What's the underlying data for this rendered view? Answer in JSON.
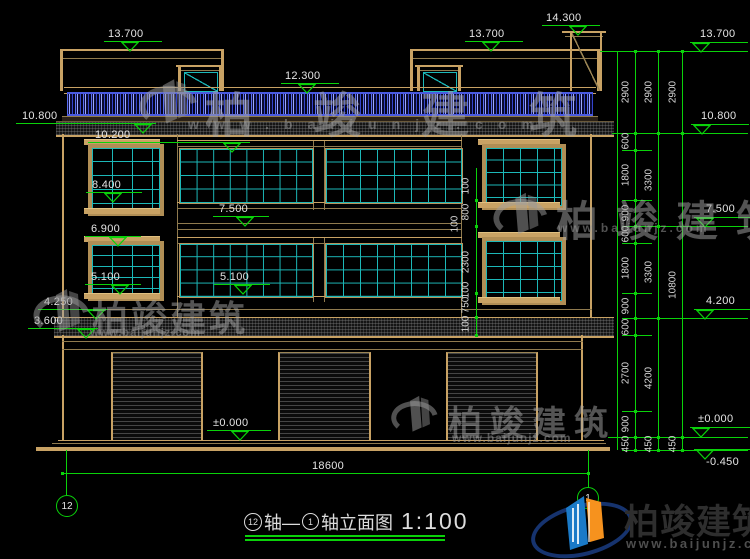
{
  "drawing": {
    "title": {
      "axis_start": "12",
      "axis_mid": "轴—",
      "axis_end": "1",
      "name": "轴立面图",
      "scale": "1:100"
    },
    "axis_bubble_left": "12",
    "axis_bubble_right": "1",
    "bottom_dimension": {
      "label": "18600"
    },
    "elevation_marks": [
      {
        "label": "13.700",
        "tx": 108,
        "ty": 28,
        "lx": 104,
        "lw": 58,
        "ly": 41,
        "cx": 130
      },
      {
        "label": "12.300",
        "tx": 285,
        "ty": 70,
        "lx": 281,
        "lw": 58,
        "ly": 83,
        "cx": 307
      },
      {
        "label": "14.300",
        "tx": 546,
        "ty": 12,
        "lx": 542,
        "lw": 58,
        "ly": 25,
        "cx": 578
      },
      {
        "label": "13.700",
        "tx": 469,
        "ty": 28,
        "lx": 465,
        "lw": 58,
        "ly": 41,
        "cx": 491
      },
      {
        "label": "10.800",
        "tx": 22,
        "ty": 110,
        "lx": 16,
        "lw": 140,
        "ly": 123,
        "cx": 143
      },
      {
        "label": "10.200",
        "tx": 95,
        "ty": 129,
        "lx": 88,
        "lw": 162,
        "ly": 142,
        "cx": 232
      },
      {
        "label": "8.400",
        "tx": 92,
        "ty": 179,
        "lx": 86,
        "lw": 56,
        "ly": 192,
        "cx": 113
      },
      {
        "label": "6.900",
        "tx": 91,
        "ty": 223,
        "lx": 85,
        "lw": 56,
        "ly": 236,
        "cx": 118
      },
      {
        "label": "5.100",
        "tx": 91,
        "ty": 271,
        "lx": 85,
        "lw": 56,
        "ly": 284,
        "cx": 120
      },
      {
        "label": "7.500",
        "tx": 219,
        "ty": 203,
        "lx": 213,
        "lw": 56,
        "ly": 216,
        "cx": 245
      },
      {
        "label": "5.100",
        "tx": 220,
        "ty": 271,
        "lx": 214,
        "lw": 56,
        "ly": 284,
        "cx": 243
      },
      {
        "label": "4.250",
        "tx": 44,
        "ty": 296,
        "lx": 38,
        "lw": 70,
        "ly": 309,
        "cx": 96
      },
      {
        "label": "3.600",
        "tx": 34,
        "ty": 315,
        "lx": 28,
        "lw": 70,
        "ly": 328,
        "cx": 86
      },
      {
        "label": "±0.000",
        "tx": 213,
        "ty": 417,
        "lx": 207,
        "lw": 64,
        "ly": 430,
        "cx": 240
      },
      {
        "label": "13.700",
        "tx": 700,
        "ty": 28,
        "lx": 690,
        "lw": 58,
        "ly": 42,
        "cx": 701
      },
      {
        "label": "10.800",
        "tx": 701,
        "ty": 110,
        "lx": 691,
        "lw": 58,
        "ly": 124,
        "cx": 702
      },
      {
        "label": "7.500",
        "tx": 706,
        "ty": 203,
        "lx": 694,
        "lw": 56,
        "ly": 217,
        "cx": 705
      },
      {
        "label": "4.200",
        "tx": 706,
        "ty": 295,
        "lx": 694,
        "lw": 56,
        "ly": 309,
        "cx": 705
      },
      {
        "label": "±0.000",
        "tx": 698,
        "ty": 413,
        "lx": 690,
        "lw": 60,
        "ly": 427,
        "cx": 701
      },
      {
        "label": "-0.450",
        "tx": 706,
        "ty": 456,
        "lx": 694,
        "lw": 56,
        "ly": 449,
        "cx": 705
      }
    ],
    "mid_chain": {
      "x": 476,
      "top": 168,
      "bottom": 336,
      "labels": [
        {
          "t": "100",
          "x": 466,
          "y": 186
        },
        {
          "t": "800",
          "x": 466,
          "y": 212
        },
        {
          "t": "100",
          "x": 455,
          "y": 224
        },
        {
          "t": "2300",
          "x": 466,
          "y": 262
        },
        {
          "t": "100",
          "x": 466,
          "y": 290
        },
        {
          "t": "750",
          "x": 466,
          "y": 305
        },
        {
          "t": "100",
          "x": 466,
          "y": 324
        }
      ],
      "ticks": [
        200,
        226,
        293,
        317,
        335
      ]
    },
    "dim_columns": [
      {
        "x": 635,
        "labels": [
          {
            "t": "2900",
            "y": 92
          },
          {
            "t": "600",
            "y": 141
          },
          {
            "t": "1800",
            "y": 175
          },
          {
            "t": "900",
            "y": 213
          },
          {
            "t": "600",
            "y": 234
          },
          {
            "t": "1800",
            "y": 268
          },
          {
            "t": "900",
            "y": 306
          },
          {
            "t": "600",
            "y": 327
          },
          {
            "t": "2700",
            "y": 373
          },
          {
            "t": "900",
            "y": 424
          },
          {
            "t": "450",
            "y": 444
          }
        ],
        "ticks": [
          51,
          133,
          150,
          200,
          226,
          243,
          293,
          318,
          335,
          411,
          437,
          450
        ]
      },
      {
        "x": 658,
        "labels": [
          {
            "t": "2900",
            "y": 92
          },
          {
            "t": "3300",
            "y": 180
          },
          {
            "t": "3300",
            "y": 272
          },
          {
            "t": "4200",
            "y": 378
          },
          {
            "t": "450",
            "y": 444
          }
        ],
        "ticks": [
          51,
          133,
          226,
          318,
          437,
          450
        ]
      },
      {
        "x": 682,
        "labels": [
          {
            "t": "2900",
            "y": 92
          },
          {
            "t": "10800",
            "y": 285
          },
          {
            "t": "450",
            "y": 444
          }
        ],
        "ticks": [
          51,
          133,
          437,
          450
        ]
      }
    ],
    "watermark": {
      "text": "柏竣建筑",
      "url": "www.baijunjz.com",
      "instances": [
        {
          "gx": 138,
          "gy": 72,
          "gs": 62,
          "cx": 205,
          "cy": 76,
          "cs": 48,
          "csp": 60,
          "wx": 188,
          "wy": 116,
          "ws": 14,
          "wsp": 15
        },
        {
          "gx": 492,
          "gy": 186,
          "gs": 58,
          "cx": 556,
          "cy": 188,
          "cs": 42,
          "csp": 18,
          "wx": 558,
          "wy": 221,
          "ws": 12,
          "wsp": 3
        },
        {
          "gx": 32,
          "gy": 282,
          "gs": 60,
          "cx": 92,
          "cy": 290,
          "cs": 36,
          "csp": 3,
          "wx": 90,
          "wy": 327,
          "ws": 11,
          "wsp": 1
        },
        {
          "gx": 390,
          "gy": 390,
          "gs": 50,
          "cx": 448,
          "cy": 396,
          "cs": 34,
          "csp": 8,
          "wx": 452,
          "wy": 431,
          "ws": 12,
          "wsp": 1
        }
      ]
    },
    "logo": {
      "text": "柏竣建筑",
      "url": "www.baijunjz.com"
    }
  },
  "colors": {
    "dim_green": "#0AD20A",
    "frame_tan": "#C8A264",
    "window_teal": "#1CB8B8",
    "baluster_blue": "#4A5AE0"
  }
}
